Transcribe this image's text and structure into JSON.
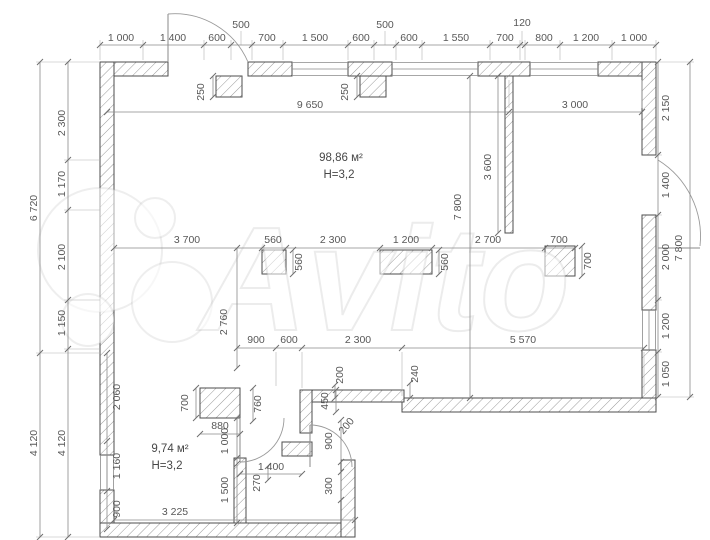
{
  "watermark": {
    "text": "Avito"
  },
  "rooms": {
    "main": {
      "area": "98,86 м²",
      "height": "Н=3,2"
    },
    "small": {
      "area": "9,74 м²",
      "height": "Н=3,2"
    }
  },
  "dims": {
    "top": [
      "1 000",
      "1 400",
      "600",
      "700",
      "1 500",
      "600",
      "600",
      "1 550",
      "700",
      "800",
      "1 200",
      "1 000"
    ],
    "top_raised": [
      "500",
      "500",
      "120"
    ],
    "top_interior": [
      "9 650",
      "3 000"
    ],
    "left_outer": [
      "6 720",
      "4 120"
    ],
    "left_inner": [
      "2 300",
      "1 170",
      "2 100",
      "1 150",
      "4 120"
    ],
    "left_wall": [
      "2 060",
      "1 160",
      "900"
    ],
    "right_inner": [
      "2 150",
      "1 400",
      "2 000",
      "1 200",
      "1 050"
    ],
    "right_outer": "7 800",
    "pilaster": [
      "250",
      "250"
    ],
    "partition_len": "3 600",
    "hall_depth": "7 800",
    "mid": [
      "3 700",
      "560",
      "2 300",
      "1 200",
      "2 700",
      "700"
    ],
    "columns": [
      "560",
      "560",
      "700"
    ],
    "passage": "2 760",
    "lower": [
      "900",
      "600",
      "2 300",
      "5 570"
    ],
    "steps": [
      "200",
      "240"
    ],
    "lobby": [
      "700",
      "760",
      "880",
      "1 000",
      "450",
      "200",
      "900",
      "1 400",
      "270",
      "300",
      "1 500",
      "3 225"
    ]
  }
}
